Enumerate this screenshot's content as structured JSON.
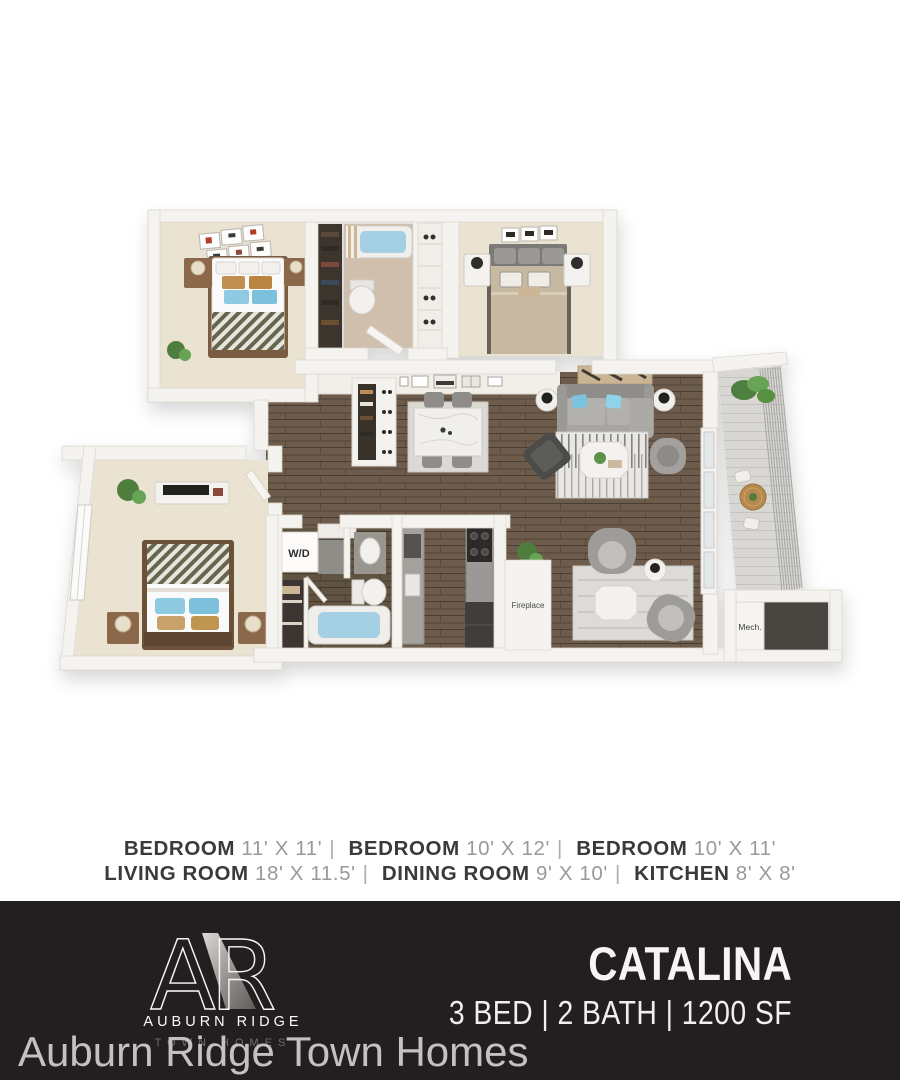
{
  "floorplan": {
    "labels": {
      "washer_dryer": "W/D",
      "fireplace": "Fireplace",
      "mechanical": "Mech."
    },
    "colors": {
      "wall": "#f5f3ef",
      "carpet": "#eae3d2",
      "wood_floor": "#6d5c4b",
      "bath_water": "#a5cfe2",
      "accent_pillow": "#7cc4de",
      "footer_bar": "#231f20"
    }
  },
  "specs": {
    "separator": "|",
    "line1": [
      {
        "name": "BEDROOM",
        "dims": "11' X 11'"
      },
      {
        "name": "BEDROOM",
        "dims": "10' X 12'"
      },
      {
        "name": "BEDROOM",
        "dims": "10' X 11'"
      }
    ],
    "line2": [
      {
        "name": "LIVING ROOM",
        "dims": "18' X 11.5'"
      },
      {
        "name": "DINING ROOM",
        "dims": "9' X 10'"
      },
      {
        "name": "KITCHEN",
        "dims": "8' X 8'"
      }
    ]
  },
  "footer": {
    "logo": {
      "monogram_a": "A",
      "monogram_r": "R",
      "name": "AUBURN RIDGE",
      "subtitle": "TOWN HOMES"
    },
    "plan_name": "CATALINA",
    "plan_specs": "3 BED | 2 BATH | 1200 SF"
  },
  "watermark": {
    "text": "Auburn Ridge Town Homes"
  }
}
